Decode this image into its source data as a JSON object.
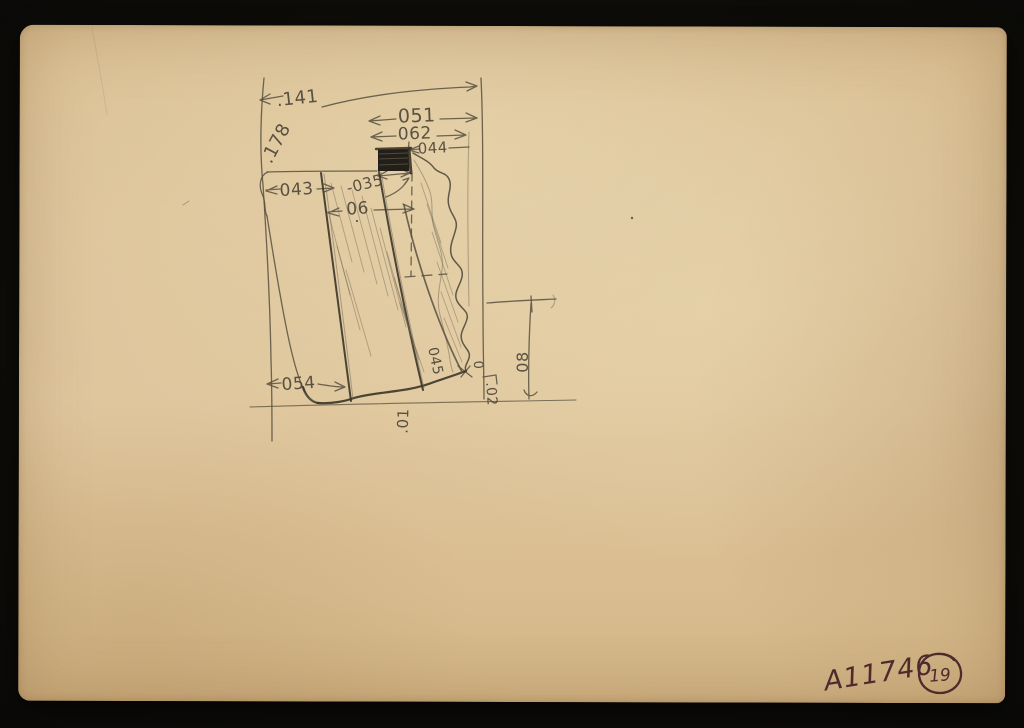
{
  "scene": {
    "type": "scanned archival sketch card",
    "background_color": "#0b0a08",
    "paper_color": "#dabf93",
    "pencil_color": "#57503f",
    "ink_color": "#4f2a2d"
  },
  "sketch": {
    "description": "Hand-drawn pencil cross-section of an artifact with dimension arrows, dashed axis and diagonal hatching",
    "dimensions": {
      "top_left_width": ".141",
      "left_height": ".178",
      "upper_width_outer": "051",
      "upper_width_mid": "062",
      "upper_width_inner": "044",
      "notch_width": "043",
      "tang_width": "-035",
      "mid_width": "06",
      "base_left": "054",
      "edge_diagonal": "045",
      "corner_zero": "0",
      "corner_offset": ".02",
      "right_height": "08",
      "base_offset": ".01"
    }
  },
  "marks": {
    "catalog_number": "A11746",
    "page_number": "19"
  }
}
